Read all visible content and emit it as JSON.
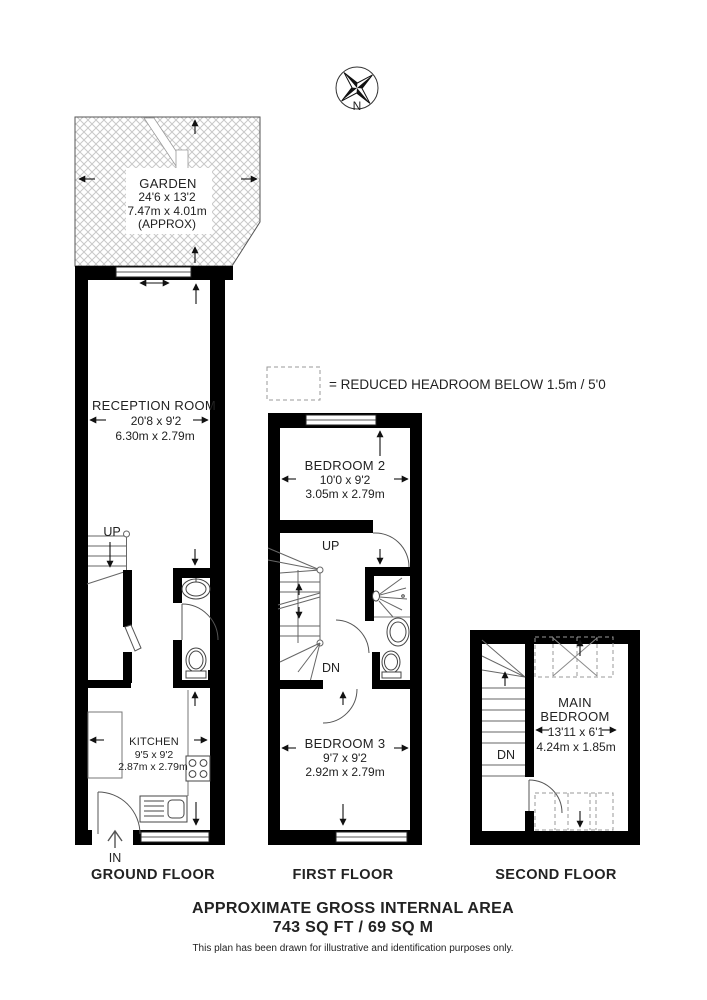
{
  "compass": {
    "north_label": "N"
  },
  "legend": {
    "label": "= REDUCED HEADROOM BELOW 1.5m / 5'0"
  },
  "garden": {
    "name": "GARDEN",
    "dims_imperial": "24'6 x 13'2",
    "dims_metric": "7.47m x 4.01m",
    "approx": "(APPROX)"
  },
  "ground_floor": {
    "title": "GROUND FLOOR",
    "in_label": "IN",
    "up_label": "UP",
    "reception": {
      "name": "RECEPTION ROOM",
      "dims_imperial": "20'8 x 9'2",
      "dims_metric": "6.30m x 2.79m"
    },
    "kitchen": {
      "name": "KITCHEN",
      "dims_imperial": "9'5 x 9'2",
      "dims_metric": "2.87m x 2.79m"
    }
  },
  "first_floor": {
    "title": "FIRST FLOOR",
    "up_label": "UP",
    "dn_label": "DN",
    "bedroom2": {
      "name": "BEDROOM 2",
      "dims_imperial": "10'0 x 9'2",
      "dims_metric": "3.05m x 2.79m"
    },
    "bedroom3": {
      "name": "BEDROOM 3",
      "dims_imperial": "9'7 x 9'2",
      "dims_metric": "2.92m x 2.79m"
    }
  },
  "second_floor": {
    "title": "SECOND FLOOR",
    "dn_label": "DN",
    "main_bedroom": {
      "name_line1": "MAIN",
      "name_line2": "BEDROOM",
      "dims_imperial": "13'11 x 6'1",
      "dims_metric": "4.24m x 1.85m"
    }
  },
  "footer": {
    "title": "APPROXIMATE GROSS INTERNAL AREA",
    "area": "743 SQ FT / 69 SQ M",
    "disclaimer": "This plan has been drawn for illustrative and identification purposes only."
  },
  "colors": {
    "wall": "#000000",
    "text": "#222222",
    "hatch": "#c8c8c8",
    "dashed": "#999999"
  }
}
